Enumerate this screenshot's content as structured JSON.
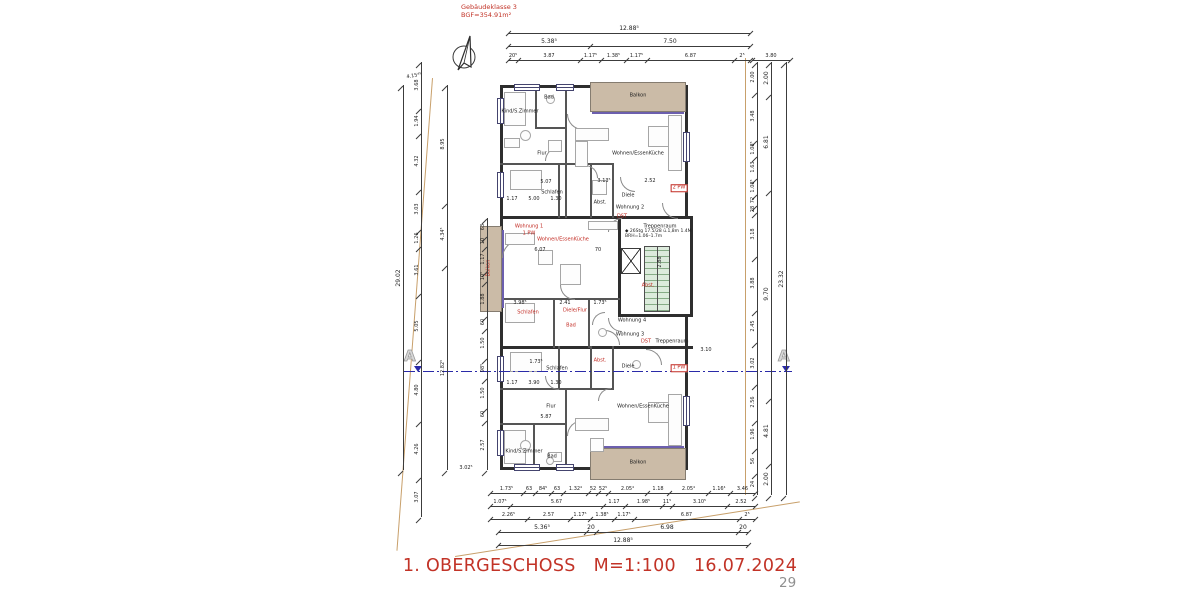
{
  "header": {
    "line1": "Gebäudeklasse 3",
    "line2": "BGF=354.91m²"
  },
  "footer": {
    "title": "1. OBERGESCHOSS",
    "scale": "M=1:100",
    "date": "16.07.2024",
    "page": "29"
  },
  "section_marker": {
    "letter": "A"
  },
  "stair_note": {
    "line1": "◆ 26Stg 17.5/28 ü.1,8m 1.4M",
    "line2": "BRH=1.06–1.7m"
  },
  "colors": {
    "red": "#c23327",
    "tan_fill": "#cbbba7",
    "tan_line": "#c8a06b",
    "stair_green": "#dcebdc",
    "section_blue": "#2a2aa8",
    "wall": "#2e2e2e"
  },
  "plan": {
    "walls": [
      [
        500,
        85,
        188,
        3
      ],
      [
        500,
        467,
        188,
        3
      ],
      [
        500,
        85,
        3,
        385
      ],
      [
        685,
        85,
        3,
        133
      ],
      [
        690,
        216,
        3,
        101
      ],
      [
        685,
        315,
        3,
        155
      ],
      [
        500,
        216,
        193,
        3
      ],
      [
        500,
        346,
        193,
        3
      ],
      [
        618,
        216,
        3,
        100
      ],
      [
        618,
        314,
        75,
        3
      ]
    ],
    "thin_walls": [
      [
        565,
        85,
        2,
        133
      ],
      [
        535,
        85,
        2,
        44
      ],
      [
        535,
        127,
        32,
        2
      ],
      [
        500,
        163,
        67,
        2
      ],
      [
        558,
        165,
        2,
        53
      ],
      [
        590,
        165,
        2,
        53
      ],
      [
        612,
        165,
        2,
        53
      ],
      [
        558,
        163,
        56,
        2
      ],
      [
        500,
        298,
        120,
        2
      ],
      [
        553,
        298,
        2,
        50
      ],
      [
        588,
        298,
        2,
        50
      ],
      [
        565,
        390,
        2,
        79
      ],
      [
        533,
        425,
        2,
        44
      ],
      [
        500,
        388,
        67,
        2
      ],
      [
        500,
        423,
        67,
        2
      ],
      [
        558,
        346,
        2,
        44
      ],
      [
        590,
        346,
        2,
        44
      ],
      [
        612,
        346,
        2,
        44
      ],
      [
        558,
        388,
        56,
        2
      ]
    ],
    "balconies": [
      [
        590,
        82,
        96,
        30
      ],
      [
        590,
        448,
        96,
        32
      ],
      [
        480,
        226,
        22,
        86
      ]
    ],
    "sills": [
      [
        592,
        112,
        92,
        2
      ],
      [
        592,
        446,
        92,
        2
      ],
      [
        502,
        230,
        2,
        78
      ]
    ],
    "stair": [
      644,
      246,
      26,
      66
    ],
    "lift": [
      621,
      248,
      20,
      26
    ],
    "windows_v": [
      [
        497,
        98,
        7,
        26
      ],
      [
        497,
        172,
        7,
        26
      ],
      [
        497,
        356,
        7,
        26
      ],
      [
        497,
        430,
        7,
        26
      ],
      [
        683,
        132,
        7,
        30
      ],
      [
        683,
        396,
        7,
        30
      ]
    ],
    "windows_h": [
      [
        514,
        84,
        26,
        7
      ],
      [
        556,
        84,
        18,
        7
      ],
      [
        514,
        464,
        26,
        7
      ],
      [
        556,
        464,
        18,
        7
      ]
    ],
    "arcs": [
      [
        567,
        130,
        16,
        0
      ],
      [
        545,
        147,
        14,
        90
      ],
      [
        598,
        165,
        13,
        180
      ],
      [
        620,
        192,
        15,
        0
      ],
      [
        502,
        240,
        18,
        90
      ],
      [
        560,
        300,
        15,
        0
      ],
      [
        592,
        312,
        13,
        90
      ],
      [
        620,
        330,
        15,
        180
      ],
      [
        567,
        420,
        16,
        90
      ],
      [
        545,
        390,
        14,
        0
      ],
      [
        598,
        388,
        13,
        90
      ],
      [
        662,
        219,
        16,
        0
      ],
      [
        662,
        349,
        16,
        180
      ],
      [
        608,
        218,
        14,
        90
      ],
      [
        608,
        332,
        14,
        0
      ]
    ],
    "furniture": [
      [
        504,
        92,
        22,
        34,
        0
      ],
      [
        504,
        138,
        16,
        10,
        0
      ],
      [
        548,
        140,
        14,
        12,
        0
      ],
      [
        510,
        170,
        32,
        20,
        0
      ],
      [
        575,
        128,
        34,
        13,
        0
      ],
      [
        575,
        141,
        13,
        26,
        0
      ],
      [
        592,
        180,
        15,
        15,
        0
      ],
      [
        648,
        126,
        21,
        21,
        0
      ],
      [
        668,
        115,
        14,
        56,
        0
      ],
      [
        546,
        95,
        9,
        9,
        1
      ],
      [
        520,
        130,
        11,
        11,
        1
      ],
      [
        505,
        233,
        30,
        12,
        0
      ],
      [
        538,
        250,
        15,
        15,
        0
      ],
      [
        560,
        264,
        21,
        21,
        0
      ],
      [
        588,
        221,
        30,
        9,
        0
      ],
      [
        505,
        303,
        30,
        20,
        0
      ],
      [
        598,
        328,
        9,
        9,
        1
      ],
      [
        632,
        360,
        9,
        9,
        1
      ],
      [
        510,
        352,
        32,
        20,
        0
      ],
      [
        575,
        418,
        34,
        13,
        0
      ],
      [
        590,
        438,
        14,
        14,
        0
      ],
      [
        648,
        402,
        21,
        21,
        0
      ],
      [
        668,
        394,
        14,
        52,
        0
      ],
      [
        504,
        430,
        22,
        34,
        0
      ],
      [
        548,
        452,
        14,
        10,
        0
      ],
      [
        546,
        457,
        8,
        8,
        1
      ],
      [
        520,
        440,
        11,
        11,
        1
      ]
    ],
    "boundaries": [
      {
        "x": 432,
        "y": 78,
        "w": 1.2,
        "h": 474,
        "rot": 4.3
      },
      {
        "x": 455,
        "y": 556,
        "w": 349,
        "h": 1.2,
        "rot": -9.0
      },
      {
        "x": 745,
        "y": 58,
        "w": 1.2,
        "h": 437,
        "rot": 0
      }
    ],
    "section": {
      "y": 371,
      "x1": 404,
      "x2": 792,
      "a_left": {
        "x": 404,
        "y": 349
      },
      "a_right": {
        "x": 778,
        "y": 349
      },
      "tri_left": {
        "x": 414,
        "y": 366
      },
      "tri_right": {
        "x": 782,
        "y": 366
      }
    }
  },
  "labels": {
    "rooms": [
      [
        "Balkon",
        638,
        96,
        "k"
      ],
      [
        "Kind/S.Zimmer",
        520,
        112,
        "k"
      ],
      [
        "Bad",
        549,
        98,
        "k"
      ],
      [
        "Flur",
        542,
        154,
        "k"
      ],
      [
        "Wohnen/EssenKüche",
        638,
        154,
        "k"
      ],
      [
        "Schlafen",
        552,
        193,
        "k"
      ],
      [
        "Abst.",
        600,
        203,
        "k"
      ],
      [
        "Diele",
        628,
        196,
        "k"
      ],
      [
        "Wohnung 2",
        630,
        208,
        "k"
      ],
      [
        "Treppenraum",
        660,
        227,
        "k"
      ],
      [
        "Wohnung 4",
        632,
        321,
        "k"
      ],
      [
        "Wohnung 3",
        630,
        335,
        "k"
      ],
      [
        "Treppenraum",
        672,
        342,
        "k"
      ],
      [
        "Diele",
        628,
        367,
        "k"
      ],
      [
        "Schlafen",
        557,
        369,
        "k"
      ],
      [
        "Flur",
        551,
        407,
        "k"
      ],
      [
        "Wohnen/EssenKüche",
        643,
        407,
        "k"
      ],
      [
        "Kind/S.Zimmer",
        524,
        452,
        "k"
      ],
      [
        "Bad",
        552,
        457,
        "k"
      ],
      [
        "Balkon",
        638,
        463,
        "k"
      ],
      [
        "Wohnung 1",
        529,
        227,
        "r"
      ],
      [
        "1 PW",
        529,
        234,
        "r"
      ],
      [
        "Wohnen/EssenKüche",
        563,
        240,
        "r"
      ],
      [
        "Balkon",
        489,
        268,
        "rv"
      ],
      [
        "Schlafen",
        528,
        313,
        "r"
      ],
      [
        "Diele/Flur",
        575,
        311,
        "r"
      ],
      [
        "Bad",
        571,
        326,
        "r"
      ],
      [
        "Abst.",
        648,
        286,
        "r"
      ],
      [
        "Abst.",
        600,
        361,
        "r"
      ],
      [
        "2 PW",
        679,
        188,
        "rb"
      ],
      [
        "1 PW",
        679,
        368,
        "rb"
      ],
      [
        "DST",
        622,
        217,
        "r"
      ],
      [
        "DST",
        646,
        342,
        "r"
      ]
    ],
    "floats": [
      [
        "4.15⁴⁵",
        414,
        76,
        -10
      ],
      [
        "3.02⁵",
        466,
        468,
        0
      ],
      [
        "3.10",
        706,
        350,
        0
      ],
      [
        "5.07",
        546,
        182,
        0
      ],
      [
        "1.17",
        512,
        199,
        0
      ],
      [
        "5.00",
        534,
        199,
        0
      ],
      [
        "1.30",
        556,
        199,
        0
      ],
      [
        "6.07",
        540,
        250,
        0
      ],
      [
        "70",
        598,
        250,
        0
      ],
      [
        "3.98⁵",
        520,
        303,
        0
      ],
      [
        "2.41",
        565,
        303,
        0
      ],
      [
        "1.73⁵",
        600,
        303,
        0
      ],
      [
        "2.88",
        660,
        262,
        -90
      ],
      [
        "3.13⁵",
        604,
        181,
        0
      ],
      [
        "2.52",
        650,
        181,
        0
      ],
      [
        "5.87",
        546,
        417,
        0
      ],
      [
        "1.17",
        512,
        383,
        0
      ],
      [
        "3.90",
        534,
        383,
        0
      ],
      [
        "1.30",
        556,
        383,
        0
      ],
      [
        "1.73⁵",
        536,
        362,
        0
      ]
    ]
  },
  "dims": {
    "h_chains": [
      {
        "x": 508,
        "y": 33,
        "segs": [
          [
            242,
            "12.88⁵"
          ]
        ],
        "big": true
      },
      {
        "x": 508,
        "y": 46,
        "segs": [
          [
            82,
            "5.38⁵"
          ],
          [
            160,
            "7.50"
          ]
        ],
        "big": true
      },
      {
        "x": 508,
        "y": 60,
        "segs": [
          [
            10,
            "20⁵"
          ],
          [
            62,
            "3.87"
          ],
          [
            21,
            "1.17⁵"
          ],
          [
            25,
            "1.38⁵"
          ],
          [
            21,
            "1.17⁵"
          ],
          [
            87,
            "6.87"
          ],
          [
            16,
            "2⁵"
          ]
        ]
      },
      {
        "x": 752,
        "y": 60,
        "segs": [
          [
            38,
            "3.80"
          ]
        ]
      },
      {
        "x": 490,
        "y": 493,
        "segs": [
          [
            33,
            "1.73⁵"
          ],
          [
            12,
            "63"
          ],
          [
            16,
            "84⁵"
          ],
          [
            12,
            "63"
          ],
          [
            25,
            "1.32⁴"
          ],
          [
            10,
            "52"
          ],
          [
            10,
            "52⁵"
          ],
          [
            39,
            "2.05⁴"
          ],
          [
            22,
            "1.18"
          ],
          [
            39,
            "2.05⁴"
          ],
          [
            22,
            "1.16⁴"
          ],
          [
            25,
            "3.46"
          ]
        ]
      },
      {
        "x": 490,
        "y": 506,
        "segs": [
          [
            20,
            "1.07⁵"
          ],
          [
            93,
            "5.67"
          ],
          [
            22,
            "1.17"
          ],
          [
            37,
            "1.98⁵"
          ],
          [
            10,
            "11⁵"
          ],
          [
            55,
            "3.10⁵"
          ],
          [
            28,
            "2.52"
          ]
        ]
      },
      {
        "x": 490,
        "y": 519,
        "segs": [
          [
            37,
            "2.26⁵"
          ],
          [
            43,
            "2.57"
          ],
          [
            20,
            "1.17⁵"
          ],
          [
            24,
            "1.38⁵"
          ],
          [
            20,
            "1.17⁵"
          ],
          [
            105,
            "6.87"
          ],
          [
            16,
            "2⁵"
          ]
        ]
      },
      {
        "x": 498,
        "y": 532,
        "segs": [
          [
            88,
            "5.36⁵"
          ],
          [
            10,
            "20"
          ],
          [
            142,
            "6.98"
          ],
          [
            10,
            "20"
          ]
        ],
        "big": true
      },
      {
        "x": 498,
        "y": 545,
        "segs": [
          [
            250,
            "12.88⁵"
          ]
        ],
        "big": true
      }
    ],
    "v_chains": [
      {
        "x": 403,
        "y": 85,
        "segs": [
          [
            385,
            "29.02"
          ]
        ],
        "big": true
      },
      {
        "x": 421,
        "y": 62,
        "segs": [
          [
            46,
            "3.68"
          ],
          [
            25,
            "1.94"
          ],
          [
            56,
            "4.32"
          ],
          [
            40,
            "3.03"
          ],
          [
            17,
            "1.26"
          ],
          [
            47,
            "3.61"
          ],
          [
            66,
            "5.05"
          ],
          [
            62,
            "4.80"
          ],
          [
            56,
            "4.26"
          ],
          [
            40,
            "3.07"
          ]
        ]
      },
      {
        "x": 447,
        "y": 85,
        "segs": [
          [
            118,
            "8.95"
          ],
          [
            62,
            "4.34⁵"
          ],
          [
            205,
            "12.82⁵"
          ]
        ]
      },
      {
        "x": 487,
        "y": 218,
        "segs": [
          [
            18,
            "63"
          ],
          [
            10,
            "10"
          ],
          [
            25,
            "1.17"
          ],
          [
            10,
            "10⁵"
          ],
          [
            35,
            "1.88"
          ],
          [
            12,
            "60"
          ],
          [
            30,
            "1.50"
          ],
          [
            20,
            "98⁵"
          ],
          [
            30,
            "1.50"
          ],
          [
            12,
            "60"
          ],
          [
            50,
            "2.57"
          ]
        ]
      },
      {
        "x": 757,
        "y": 62,
        "segs": [
          [
            30,
            "2.00"
          ],
          [
            48,
            "3.48"
          ],
          [
            16,
            "1.08⁵"
          ],
          [
            22,
            "1.63"
          ],
          [
            16,
            "1.08⁵"
          ],
          [
            11,
            "72"
          ],
          [
            7,
            "28"
          ],
          [
            44,
            "3.18"
          ],
          [
            54,
            "3.88"
          ],
          [
            32,
            "2.45"
          ],
          [
            42,
            "3.02"
          ],
          [
            36,
            "2.56"
          ],
          [
            28,
            "1.96"
          ],
          [
            25,
            "56"
          ],
          [
            22,
            "24"
          ]
        ]
      },
      {
        "x": 771,
        "y": 62,
        "segs": [
          [
            32,
            "2.00"
          ],
          [
            96,
            "6.81"
          ],
          [
            208,
            "9.70"
          ],
          [
            65,
            "4.81"
          ],
          [
            32,
            "2.00"
          ]
        ],
        "big": true
      },
      {
        "x": 786,
        "y": 62,
        "segs": [
          [
            433,
            "23.32"
          ]
        ],
        "big": true
      }
    ]
  }
}
